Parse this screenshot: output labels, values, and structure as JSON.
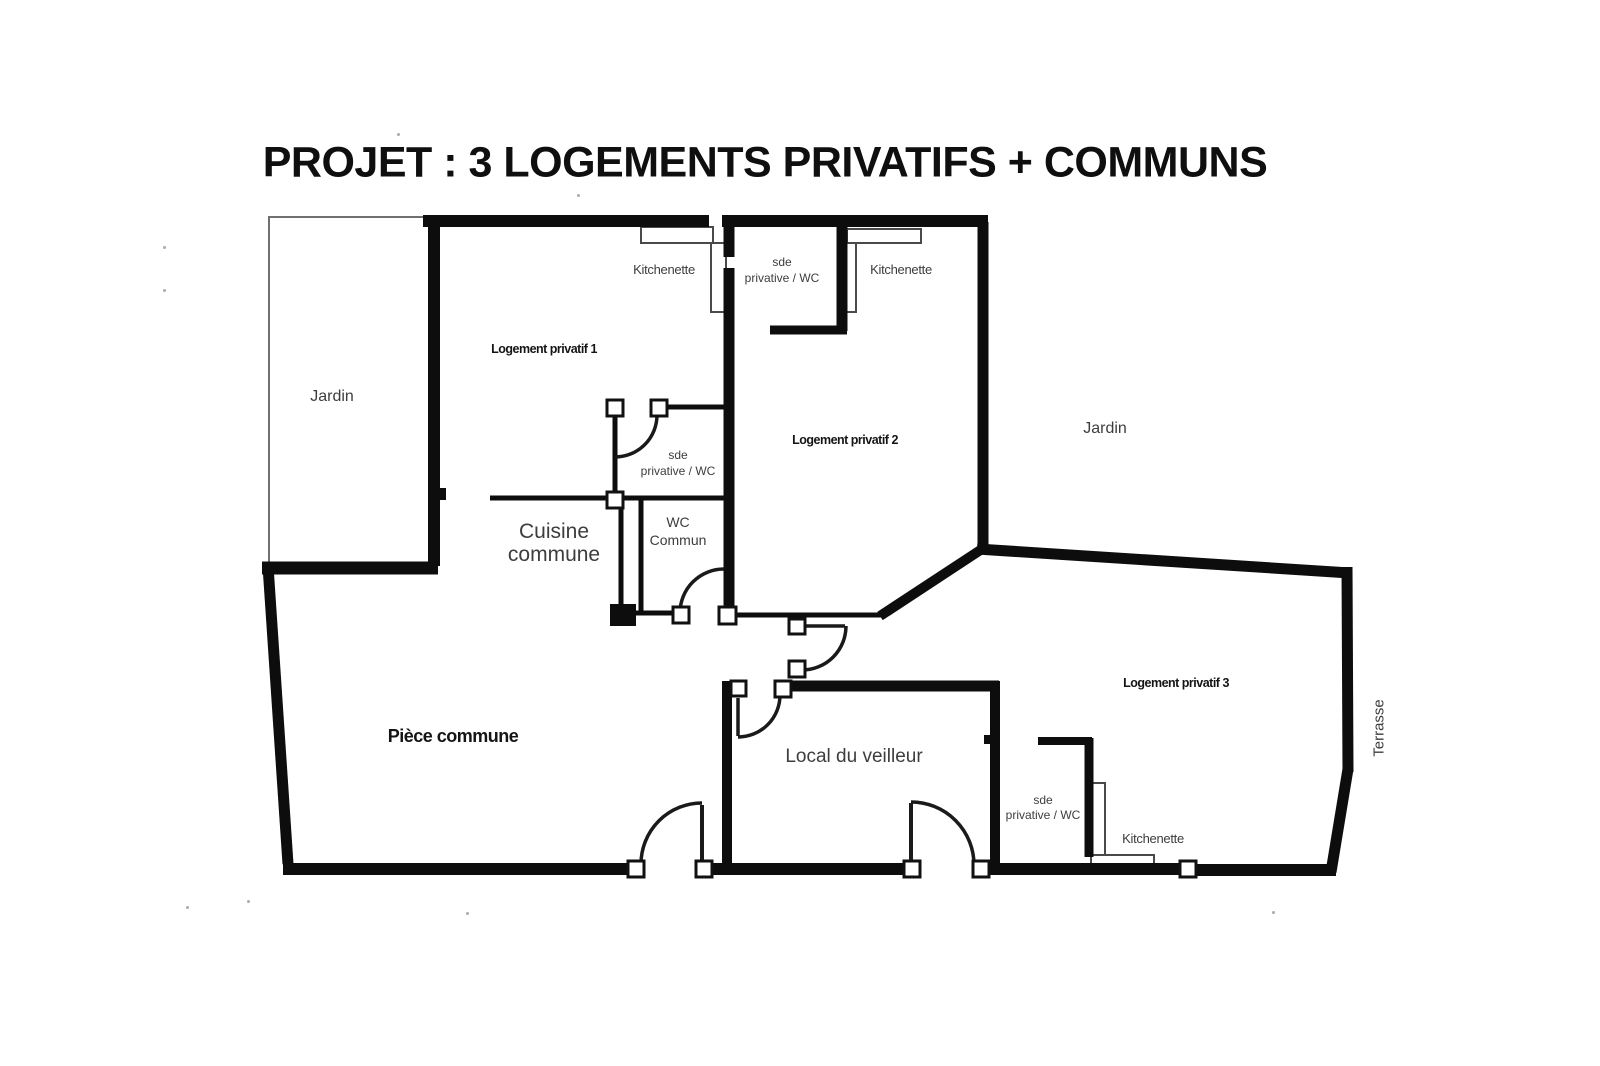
{
  "title": "PROJET : 3 LOGEMENTS PRIVATIFS + COMMUNS",
  "labels": {
    "jardin_left": "Jardin",
    "jardin_right": "Jardin",
    "terrasse": "Terrasse",
    "logement_1": "Logement privatif 1",
    "logement_2": "Logement privatif 2",
    "logement_3": "Logement privatif 3",
    "kitchenette_1": "Kitchenette",
    "kitchenette_2": "Kitchenette",
    "kitchenette_3": "Kitchenette",
    "sde_1": "sde\nprivative / WC",
    "sde_2": "sde\nprivative / WC",
    "sde_3": "sde\nprivative / WC",
    "wc_commun": "WC\nCommun",
    "cuisine_commune": "Cuisine\ncommune",
    "piece_commune": "Pièce commune",
    "local_veilleur": "Local du veilleur"
  },
  "colors": {
    "background": "#ffffff",
    "wall": "#0d0d0d",
    "label": "#3d3d3d",
    "strong_label": "#151515"
  }
}
